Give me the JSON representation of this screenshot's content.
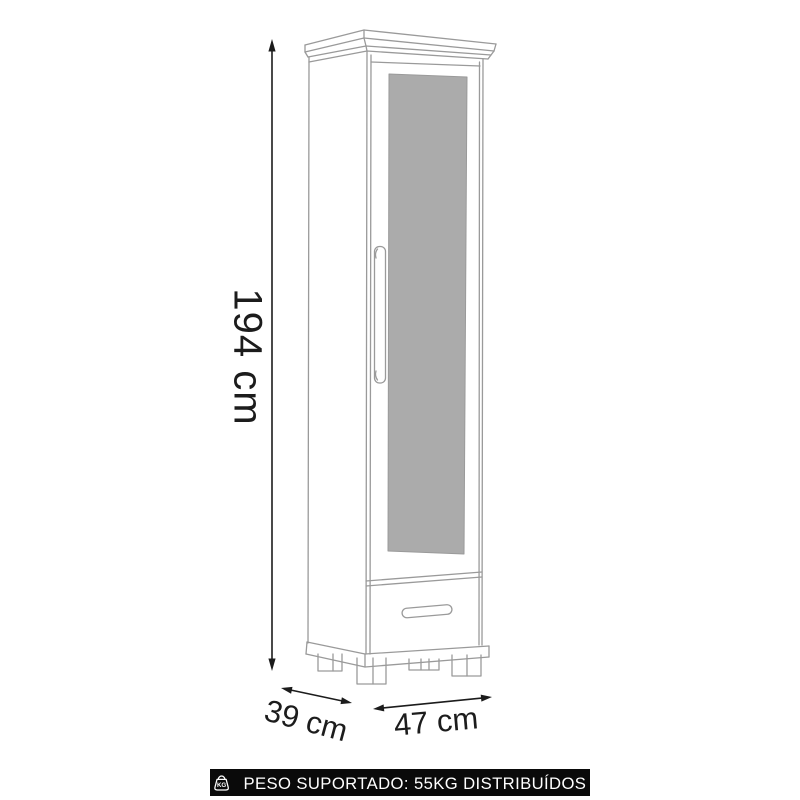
{
  "diagram": {
    "subject": "tall wardrobe cabinet with mirror door, drawer and block feet",
    "dimensions": {
      "height_label": "194 cm",
      "depth_label": "39 cm",
      "width_label": "47 cm"
    },
    "colors": {
      "line_gray": "#9a9a9a",
      "mirror_fill": "#ababab",
      "dimension_ink": "#1c1c1c",
      "banner_bg": "#0a0a0a",
      "banner_text": "#ffffff"
    }
  },
  "banner": {
    "icon": "kg-weight-icon",
    "text": "PESO SUPORTADO: 55KG DISTRIBUÍDOS"
  }
}
